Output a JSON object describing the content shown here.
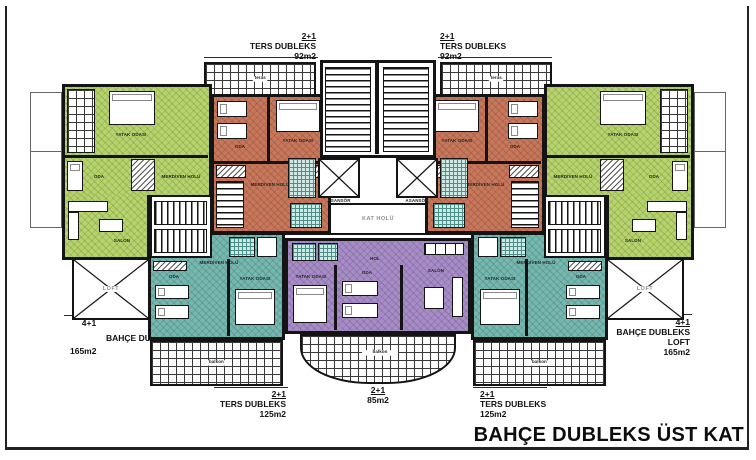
{
  "title": "BAHÇE DUBLEKS ÜST KAT",
  "units": {
    "top_left": {
      "type": "2+1",
      "name": "TERS DUBLEKS",
      "area": "92m2"
    },
    "top_right": {
      "type": "2+1",
      "name": "TERS DUBLEKS",
      "area": "92m2"
    },
    "bottom_left": {
      "type": "2+1",
      "name": "TERS DUBLEKS",
      "area": "125m2"
    },
    "bottom_right": {
      "type": "2+1",
      "name": "TERS DUBLEKS",
      "area": "125m2"
    },
    "center": {
      "type": "2+1",
      "area": "85m2"
    },
    "garden_left": {
      "type": "4+1",
      "name": "BAHÇE DUBLEKS",
      "area": "165m2"
    },
    "garden_right": {
      "type": "4+1",
      "name": "BAHÇE DUBLEKS",
      "loft": "LOFT",
      "area": "165m2"
    }
  },
  "core": {
    "elevator": "ASANSÖR",
    "floor_hall": "KAT HOLÜ"
  },
  "rooms": {
    "bedroom": "YATAK ODASI",
    "room": "ODA",
    "hall": "HOL",
    "stair_hall": "MERDİVEN HOLÜ",
    "living": "SALON",
    "bath": "BANYO",
    "balcony": "balkon",
    "terrace": "teras",
    "loft": "LOFT"
  },
  "colors": {
    "orange": "#c8775b",
    "green": "#b6d46b",
    "teal": "#74b8b0",
    "purple": "#a78cc8",
    "wall": "#141414"
  }
}
